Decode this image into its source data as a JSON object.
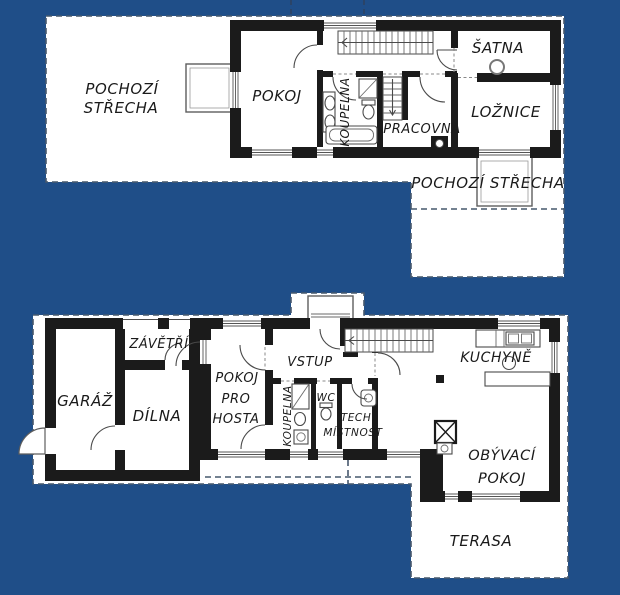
{
  "colors": {
    "background": "#1f4e88",
    "plan_fill": "#ffffff",
    "wall": "#1b1b1b",
    "dashed_outline": "#47586d",
    "line": "#4a4a4a",
    "text": "#1a1a1a"
  },
  "upper": {
    "pochozi_strecha_left_line1": "POCHOZÍ",
    "pochozi_strecha_left_line2": "STŘECHA",
    "pokoj": "POKOJ",
    "koupelna": "KOUPELNA",
    "satna": "ŠATNA",
    "pracovna": "PRACOVNA",
    "loznice": "LOŽNICE",
    "pochozi_strecha_right": "POCHOZÍ STŘECHA"
  },
  "lower": {
    "zavetri": "ZÁVĚTŘÍ",
    "garaz": "GARÁŽ",
    "dilna": "DÍLNA",
    "pokoj_pro_hosta_line1": "POKOJ",
    "pokoj_pro_hosta_line2": "PRO",
    "pokoj_pro_hosta_line3": "HOSTA",
    "vstup": "VSTUP",
    "koupelna": "KOUPELNA",
    "wc": "WC",
    "tech_line1": "TECH.",
    "tech_line2": "MÍSTNOST",
    "kuchyne": "KUCHYNĚ",
    "obyvaci_line1": "OBÝVACÍ",
    "obyvaci_line2": "POKOJ",
    "terasa": "TERASA"
  }
}
